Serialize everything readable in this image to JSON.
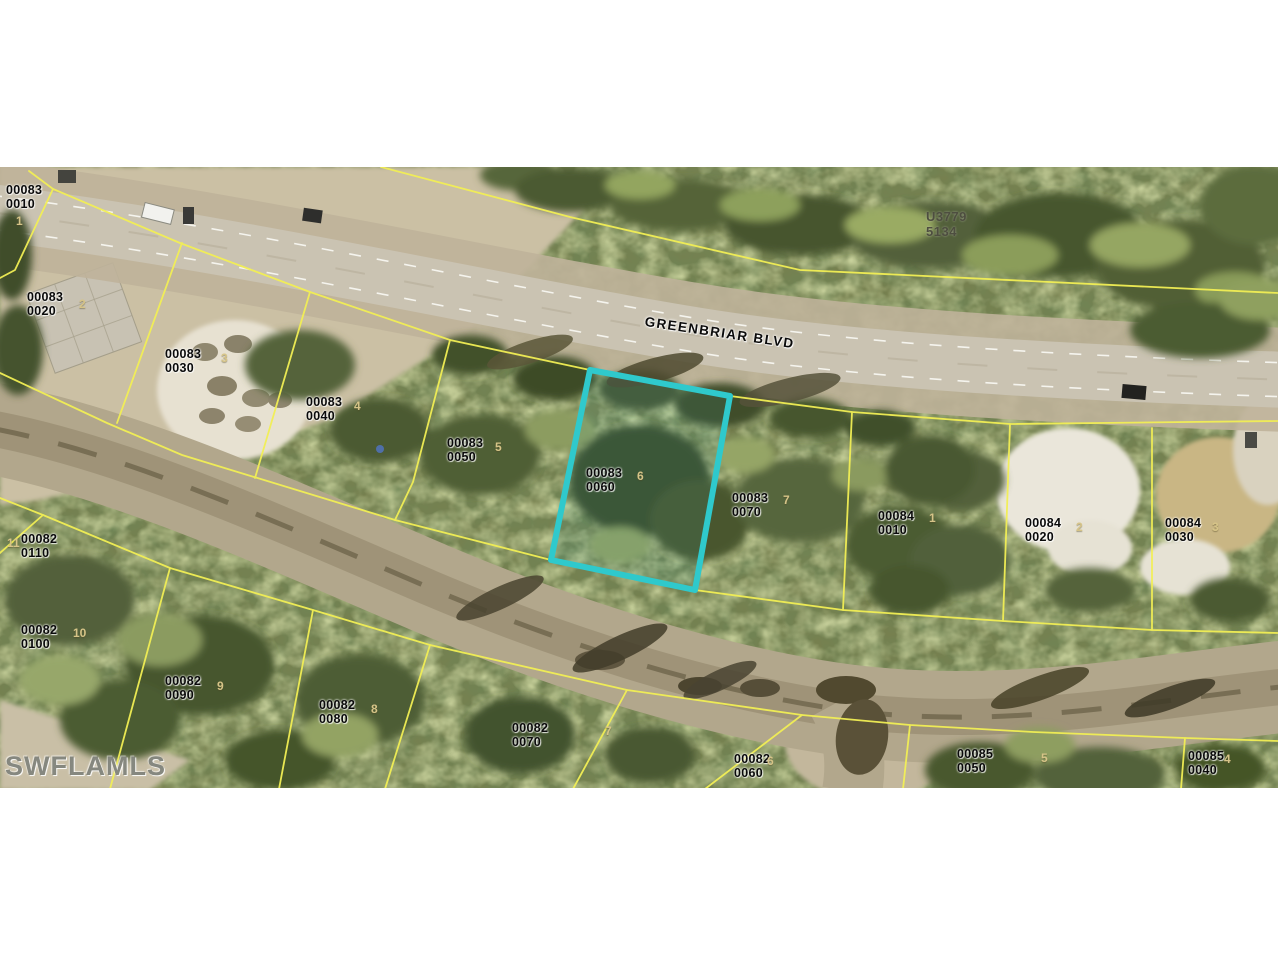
{
  "map": {
    "watermark": "SWFLAMLS",
    "street": {
      "name": "GREENBRIAR BLVD"
    },
    "adjacent_parcel": {
      "line1": "U3779",
      "line2": "5134"
    },
    "highlighted_parcel": "00083 0060",
    "colors": {
      "parcel_line": "#f2ef55",
      "highlight": "#2fc9cc",
      "label": "#0a0a0a",
      "lot_number": "#d6c488"
    },
    "parcels": [
      {
        "line1": "00083",
        "line2": "0010",
        "lot": "1"
      },
      {
        "line1": "00083",
        "line2": "0020",
        "lot": "2"
      },
      {
        "line1": "00083",
        "line2": "0030",
        "lot": "3"
      },
      {
        "line1": "00083",
        "line2": "0040",
        "lot": "4"
      },
      {
        "line1": "00083",
        "line2": "0050",
        "lot": "5"
      },
      {
        "line1": "00083",
        "line2": "0060",
        "lot": "6"
      },
      {
        "line1": "00083",
        "line2": "0070",
        "lot": "7"
      },
      {
        "line1": "00084",
        "line2": "0010",
        "lot": "1"
      },
      {
        "line1": "00084",
        "line2": "0020",
        "lot": "2"
      },
      {
        "line1": "00084",
        "line2": "0030",
        "lot": "3"
      },
      {
        "line1": "00082",
        "line2": "0110",
        "lot": "11"
      },
      {
        "line1": "00082",
        "line2": "0100",
        "lot": "10"
      },
      {
        "line1": "00082",
        "line2": "0090",
        "lot": "9"
      },
      {
        "line1": "00082",
        "line2": "0080",
        "lot": "8"
      },
      {
        "line1": "00082",
        "line2": "0070",
        "lot": "7"
      },
      {
        "line1": "00082",
        "line2": "0060",
        "lot": "6"
      },
      {
        "line1": "00085",
        "line2": "0050",
        "lot": "5"
      },
      {
        "line1": "00085",
        "line2": "0040",
        "lot": "4"
      }
    ]
  }
}
